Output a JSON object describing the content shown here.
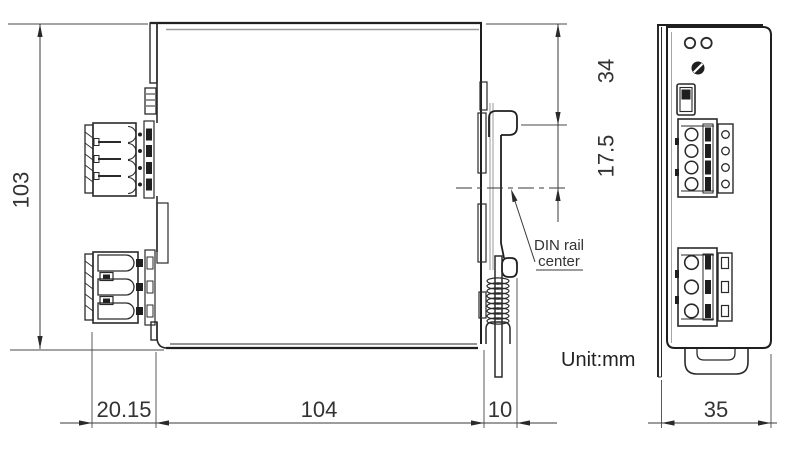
{
  "labels": {
    "unit": "Unit:mm",
    "din_rail_line1": "DIN rail",
    "din_rail_line2": "center"
  },
  "dimensions": {
    "overall_height": "103",
    "rail_top_offset": "34",
    "rail_center_offset": "17.5",
    "connector_depth": "20.15",
    "body_depth": "104",
    "rail_clearance": "10",
    "front_width": "35"
  },
  "colors": {
    "line": "#1f1f1f",
    "dimension": "#3a3a3a",
    "text": "#333333",
    "background": "#ffffff"
  }
}
